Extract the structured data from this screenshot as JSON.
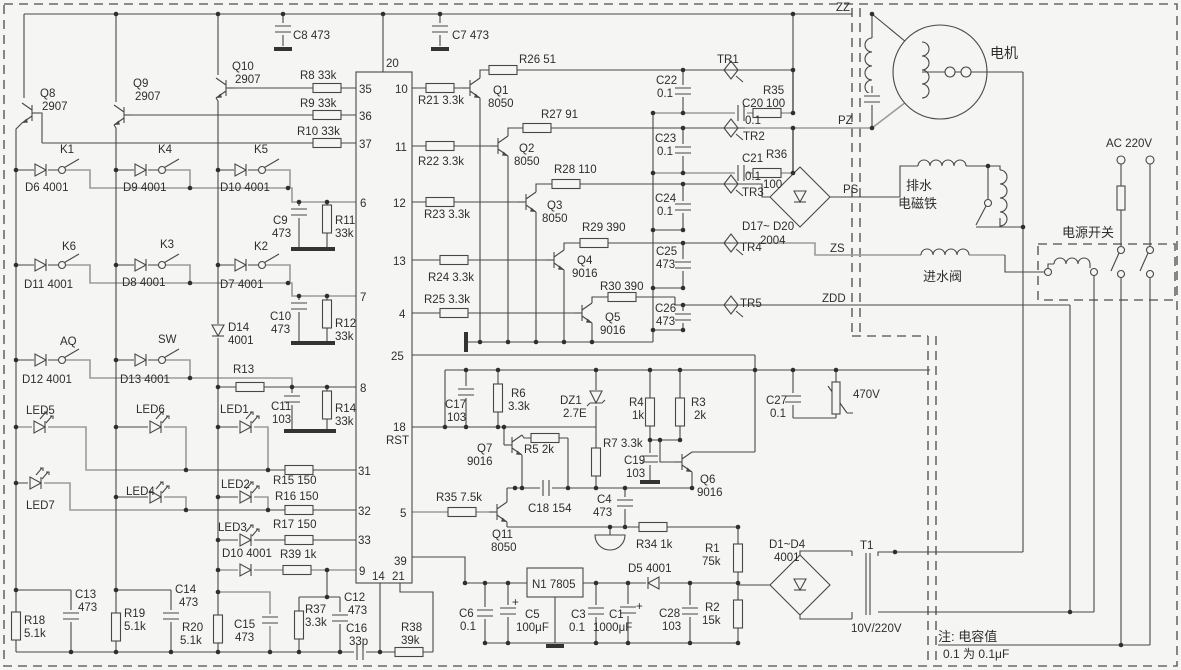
{
  "diagram": {
    "type": "circuit-schematic",
    "subject": "washing machine controller board",
    "note_line1": "注: 电容值",
    "note_line2": "0.1 为 0.1μF",
    "net_labels": [
      "ZZ",
      "PZ",
      "PS",
      "ZS",
      "ZDD"
    ],
    "loads": {
      "motor": "电机",
      "drain_solenoid": "排水 电磁铁",
      "inlet_valve": "进水阀",
      "power_switch": "电源开关",
      "mains": "AC 220V",
      "transformer_ratio": "10V/220V"
    }
  },
  "labels": [
    {
      "t": "C8 473",
      "x": 293,
      "y": 39
    },
    {
      "t": "C7 473",
      "x": 452,
      "y": 39
    },
    {
      "t": "20",
      "x": 386,
      "y": 67
    },
    {
      "t": "R8 33k",
      "x": 300,
      "y": 79
    },
    {
      "t": "R9 33k",
      "x": 300,
      "y": 107
    },
    {
      "t": "R10 33k",
      "x": 297,
      "y": 135
    },
    {
      "t": "Q8",
      "x": 40,
      "y": 97
    },
    {
      "t": "2907",
      "x": 42,
      "y": 110
    },
    {
      "t": "Q9",
      "x": 133,
      "y": 87
    },
    {
      "t": "2907",
      "x": 135,
      "y": 100
    },
    {
      "t": "Q10",
      "x": 232,
      "y": 70
    },
    {
      "t": "2907",
      "x": 235,
      "y": 83
    },
    {
      "t": "K1",
      "x": 60,
      "y": 153
    },
    {
      "t": "D6 4001",
      "x": 25,
      "y": 191
    },
    {
      "t": "K4",
      "x": 158,
      "y": 153
    },
    {
      "t": "D9 4001",
      "x": 123,
      "y": 191
    },
    {
      "t": "K5",
      "x": 254,
      "y": 153
    },
    {
      "t": "D10 4001",
      "x": 220,
      "y": 191
    },
    {
      "t": "K6",
      "x": 62,
      "y": 250
    },
    {
      "t": "D11 4001",
      "x": 24,
      "y": 288
    },
    {
      "t": "K3",
      "x": 160,
      "y": 248
    },
    {
      "t": "D8 4001",
      "x": 122,
      "y": 286
    },
    {
      "t": "K2",
      "x": 254,
      "y": 250
    },
    {
      "t": "D7 4001",
      "x": 220,
      "y": 288
    },
    {
      "t": "AQ",
      "x": 60,
      "y": 345
    },
    {
      "t": "D12 4001",
      "x": 22,
      "y": 383
    },
    {
      "t": "SW",
      "x": 158,
      "y": 343
    },
    {
      "t": "D13 4001",
      "x": 120,
      "y": 383
    },
    {
      "t": "D14",
      "x": 228,
      "y": 331
    },
    {
      "t": "4001",
      "x": 228,
      "y": 344
    },
    {
      "t": "R13",
      "x": 233,
      "y": 373
    },
    {
      "t": "C9",
      "x": 273,
      "y": 224
    },
    {
      "t": "473",
      "x": 272,
      "y": 237
    },
    {
      "t": "R11",
      "x": 335,
      "y": 224
    },
    {
      "t": "33k",
      "x": 335,
      "y": 237
    },
    {
      "t": "C10",
      "x": 270,
      "y": 320
    },
    {
      "t": "473",
      "x": 271,
      "y": 333
    },
    {
      "t": "R12",
      "x": 335,
      "y": 327
    },
    {
      "t": "33k",
      "x": 335,
      "y": 340
    },
    {
      "t": "C11",
      "x": 271,
      "y": 410
    },
    {
      "t": "103",
      "x": 272,
      "y": 423
    },
    {
      "t": "R14",
      "x": 335,
      "y": 412
    },
    {
      "t": "33k",
      "x": 335,
      "y": 425
    },
    {
      "t": "LED5",
      "x": 26,
      "y": 414
    },
    {
      "t": "LED6",
      "x": 136,
      "y": 413
    },
    {
      "t": "LED1",
      "x": 220,
      "y": 413
    },
    {
      "t": "LED7",
      "x": 26,
      "y": 509
    },
    {
      "t": "LED4",
      "x": 126,
      "y": 495
    },
    {
      "t": "LED2",
      "x": 221,
      "y": 488
    },
    {
      "t": "LED3",
      "x": 218,
      "y": 531
    },
    {
      "t": "D10 4001",
      "x": 222,
      "y": 557
    },
    {
      "t": "R15 150",
      "x": 273,
      "y": 484
    },
    {
      "t": "R16 150",
      "x": 275,
      "y": 500
    },
    {
      "t": "R17 150",
      "x": 273,
      "y": 528
    },
    {
      "t": "R39 1k",
      "x": 280,
      "y": 558
    },
    {
      "t": "35",
      "x": 359,
      "y": 93
    },
    {
      "t": "36",
      "x": 359,
      "y": 120
    },
    {
      "t": "37",
      "x": 359,
      "y": 148
    },
    {
      "t": "6",
      "x": 360,
      "y": 207
    },
    {
      "t": "7",
      "x": 360,
      "y": 301
    },
    {
      "t": "8",
      "x": 360,
      "y": 392
    },
    {
      "t": "31",
      "x": 358,
      "y": 475
    },
    {
      "t": "32",
      "x": 358,
      "y": 515
    },
    {
      "t": "33",
      "x": 358,
      "y": 544
    },
    {
      "t": "9",
      "x": 359,
      "y": 575
    },
    {
      "t": "10",
      "x": 395,
      "y": 93
    },
    {
      "t": "11",
      "x": 395,
      "y": 151
    },
    {
      "t": "12",
      "x": 393,
      "y": 207
    },
    {
      "t": "13",
      "x": 393,
      "y": 265
    },
    {
      "t": "4",
      "x": 399,
      "y": 318
    },
    {
      "t": "25",
      "x": 391,
      "y": 360
    },
    {
      "t": "18",
      "x": 393,
      "y": 431
    },
    {
      "t": "RST",
      "x": 386,
      "y": 444
    },
    {
      "t": "5",
      "x": 400,
      "y": 517
    },
    {
      "t": "39",
      "x": 394,
      "y": 565
    },
    {
      "t": "14",
      "x": 372,
      "y": 580
    },
    {
      "t": "21",
      "x": 392,
      "y": 580
    },
    {
      "t": "R21 3.3k",
      "x": 418,
      "y": 104
    },
    {
      "t": "R22 3.3k",
      "x": 418,
      "y": 165
    },
    {
      "t": "R23 3.3k",
      "x": 424,
      "y": 218
    },
    {
      "t": "R24 3.3k",
      "x": 428,
      "y": 281
    },
    {
      "t": "R25 3.3k",
      "x": 424,
      "y": 303
    },
    {
      "t": "Q1",
      "x": 493,
      "y": 94
    },
    {
      "t": "8050",
      "x": 488,
      "y": 107
    },
    {
      "t": "Q2",
      "x": 519,
      "y": 152
    },
    {
      "t": "8050",
      "x": 514,
      "y": 165
    },
    {
      "t": "Q3",
      "x": 547,
      "y": 209
    },
    {
      "t": "8050",
      "x": 542,
      "y": 222
    },
    {
      "t": "Q4",
      "x": 577,
      "y": 264
    },
    {
      "t": "9016",
      "x": 572,
      "y": 277
    },
    {
      "t": "Q5",
      "x": 605,
      "y": 321
    },
    {
      "t": "9016",
      "x": 600,
      "y": 334
    },
    {
      "t": "R26 51",
      "x": 519,
      "y": 63
    },
    {
      "t": "R27 91",
      "x": 541,
      "y": 118
    },
    {
      "t": "R28 110",
      "x": 554,
      "y": 173
    },
    {
      "t": "R29 390",
      "x": 582,
      "y": 231
    },
    {
      "t": "R30 390",
      "x": 600,
      "y": 290
    },
    {
      "t": "C22",
      "x": 656,
      "y": 84
    },
    {
      "t": "0.1",
      "x": 657,
      "y": 97
    },
    {
      "t": "C23",
      "x": 655,
      "y": 142
    },
    {
      "t": "0.1",
      "x": 657,
      "y": 155
    },
    {
      "t": "C24",
      "x": 655,
      "y": 202
    },
    {
      "t": "0.1",
      "x": 657,
      "y": 215
    },
    {
      "t": "C25",
      "x": 656,
      "y": 255
    },
    {
      "t": "473",
      "x": 656,
      "y": 268
    },
    {
      "t": "C26",
      "x": 655,
      "y": 312
    },
    {
      "t": "473",
      "x": 656,
      "y": 325
    },
    {
      "t": "TR1",
      "x": 717,
      "y": 63
    },
    {
      "t": "TR2",
      "x": 743,
      "y": 140
    },
    {
      "t": "TR3",
      "x": 742,
      "y": 196
    },
    {
      "t": "TR4",
      "x": 740,
      "y": 251
    },
    {
      "t": "TR5",
      "x": 740,
      "y": 307
    },
    {
      "t": "C20",
      "x": 742,
      "y": 107
    },
    {
      "t": "0.1",
      "x": 745,
      "y": 124
    },
    {
      "t": "R35",
      "x": 763,
      "y": 94
    },
    {
      "t": "100",
      "x": 766,
      "y": 107
    },
    {
      "t": "C21",
      "x": 742,
      "y": 162
    },
    {
      "t": "0.1",
      "x": 745,
      "y": 180
    },
    {
      "t": "R36",
      "x": 766,
      "y": 158
    },
    {
      "t": "100",
      "x": 763,
      "y": 188
    },
    {
      "t": "D17~ D20",
      "x": 742,
      "y": 230
    },
    {
      "t": "2004",
      "x": 760,
      "y": 244
    },
    {
      "t": "PS",
      "x": 843,
      "y": 193
    },
    {
      "t": "ZZ",
      "x": 836,
      "y": 11
    },
    {
      "t": "PZ",
      "x": 838,
      "y": 124
    },
    {
      "t": "ZS",
      "x": 830,
      "y": 252
    },
    {
      "t": "ZDD",
      "x": 822,
      "y": 302
    },
    {
      "t": "电机",
      "x": 990,
      "y": 58,
      "f": 14
    },
    {
      "t": "排水",
      "x": 906,
      "y": 190,
      "f": 13
    },
    {
      "t": "电磁铁",
      "x": 898,
      "y": 208,
      "f": 13
    },
    {
      "t": "进水阀",
      "x": 923,
      "y": 281,
      "f": 13
    },
    {
      "t": "电源开关",
      "x": 1062,
      "y": 237,
      "f": 13
    },
    {
      "t": "AC 220V",
      "x": 1106,
      "y": 147
    },
    {
      "t": "C27",
      "x": 766,
      "y": 404
    },
    {
      "t": "0.1",
      "x": 770,
      "y": 417
    },
    {
      "t": "470V",
      "x": 853,
      "y": 398
    },
    {
      "t": "C17",
      "x": 445,
      "y": 408
    },
    {
      "t": "103",
      "x": 447,
      "y": 421
    },
    {
      "t": "R6",
      "x": 511,
      "y": 397
    },
    {
      "t": "3.3k",
      "x": 508,
      "y": 410
    },
    {
      "t": "DZ1",
      "x": 560,
      "y": 404
    },
    {
      "t": "2.7E",
      "x": 563,
      "y": 417
    },
    {
      "t": "R4",
      "x": 629,
      "y": 406
    },
    {
      "t": "1k",
      "x": 632,
      "y": 419
    },
    {
      "t": "R3",
      "x": 691,
      "y": 406
    },
    {
      "t": "2k",
      "x": 694,
      "y": 419
    },
    {
      "t": "Q7",
      "x": 477,
      "y": 452
    },
    {
      "t": "9016",
      "x": 467,
      "y": 465
    },
    {
      "t": "R5 2k",
      "x": 524,
      "y": 453
    },
    {
      "t": "R7 3.3k",
      "x": 603,
      "y": 447
    },
    {
      "t": "C19",
      "x": 624,
      "y": 464
    },
    {
      "t": "103",
      "x": 626,
      "y": 477
    },
    {
      "t": "C18 154",
      "x": 528,
      "y": 512
    },
    {
      "t": "R35 7.5k",
      "x": 436,
      "y": 501
    },
    {
      "t": "Q6",
      "x": 700,
      "y": 483
    },
    {
      "t": "9016",
      "x": 697,
      "y": 496
    },
    {
      "t": "Q11",
      "x": 492,
      "y": 538
    },
    {
      "t": "8050",
      "x": 491,
      "y": 551
    },
    {
      "t": "C4",
      "x": 597,
      "y": 503
    },
    {
      "t": "473",
      "x": 593,
      "y": 516
    },
    {
      "t": "R34 1k",
      "x": 636,
      "y": 548
    },
    {
      "t": "D5 4001",
      "x": 628,
      "y": 572
    },
    {
      "t": "R1",
      "x": 705,
      "y": 552
    },
    {
      "t": "75k",
      "x": 702,
      "y": 565
    },
    {
      "t": "R2",
      "x": 705,
      "y": 611
    },
    {
      "t": "15k",
      "x": 702,
      "y": 624
    },
    {
      "t": "C28",
      "x": 659,
      "y": 617
    },
    {
      "t": "103",
      "x": 662,
      "y": 630
    },
    {
      "t": "N1 7805",
      "x": 532,
      "y": 588
    },
    {
      "t": "C6",
      "x": 459,
      "y": 617
    },
    {
      "t": "0.1",
      "x": 460,
      "y": 630
    },
    {
      "t": "+",
      "x": 512,
      "y": 606
    },
    {
      "t": "C5",
      "x": 525,
      "y": 618
    },
    {
      "t": "100μF",
      "x": 516,
      "y": 631
    },
    {
      "t": "C3",
      "x": 571,
      "y": 618
    },
    {
      "t": "0.1",
      "x": 569,
      "y": 631
    },
    {
      "t": "C1",
      "x": 609,
      "y": 618
    },
    {
      "t": "1000μF",
      "x": 593,
      "y": 631
    },
    {
      "t": "+",
      "x": 636,
      "y": 610
    },
    {
      "t": "D1~D4",
      "x": 769,
      "y": 548
    },
    {
      "t": "4001",
      "x": 774,
      "y": 561
    },
    {
      "t": "T1",
      "x": 860,
      "y": 549
    },
    {
      "t": "10V/220V",
      "x": 851,
      "y": 632
    },
    {
      "t": "注: 电容值",
      "x": 938,
      "y": 641,
      "f": 13
    },
    {
      "t": "0.1 为 0.1μF",
      "x": 943,
      "y": 658,
      "f": 12
    },
    {
      "t": "R18",
      "x": 24,
      "y": 624
    },
    {
      "t": "5.1k",
      "x": 24,
      "y": 637
    },
    {
      "t": "C13",
      "x": 75,
      "y": 598
    },
    {
      "t": "473",
      "x": 78,
      "y": 611
    },
    {
      "t": "R19",
      "x": 124,
      "y": 617
    },
    {
      "t": "5.1k",
      "x": 124,
      "y": 630
    },
    {
      "t": "C14",
      "x": 175,
      "y": 593
    },
    {
      "t": "473",
      "x": 179,
      "y": 606
    },
    {
      "t": "R20",
      "x": 182,
      "y": 631
    },
    {
      "t": "5.1k",
      "x": 180,
      "y": 644
    },
    {
      "t": "C15",
      "x": 234,
      "y": 628
    },
    {
      "t": "473",
      "x": 235,
      "y": 641
    },
    {
      "t": "R37",
      "x": 305,
      "y": 613
    },
    {
      "t": "3.3k",
      "x": 305,
      "y": 626
    },
    {
      "t": "C12",
      "x": 344,
      "y": 601
    },
    {
      "t": "473",
      "x": 348,
      "y": 614
    },
    {
      "t": "C16",
      "x": 346,
      "y": 632
    },
    {
      "t": "33p",
      "x": 349,
      "y": 645
    },
    {
      "t": "R38",
      "x": 401,
      "y": 631
    },
    {
      "t": "39k",
      "x": 401,
      "y": 644
    }
  ]
}
